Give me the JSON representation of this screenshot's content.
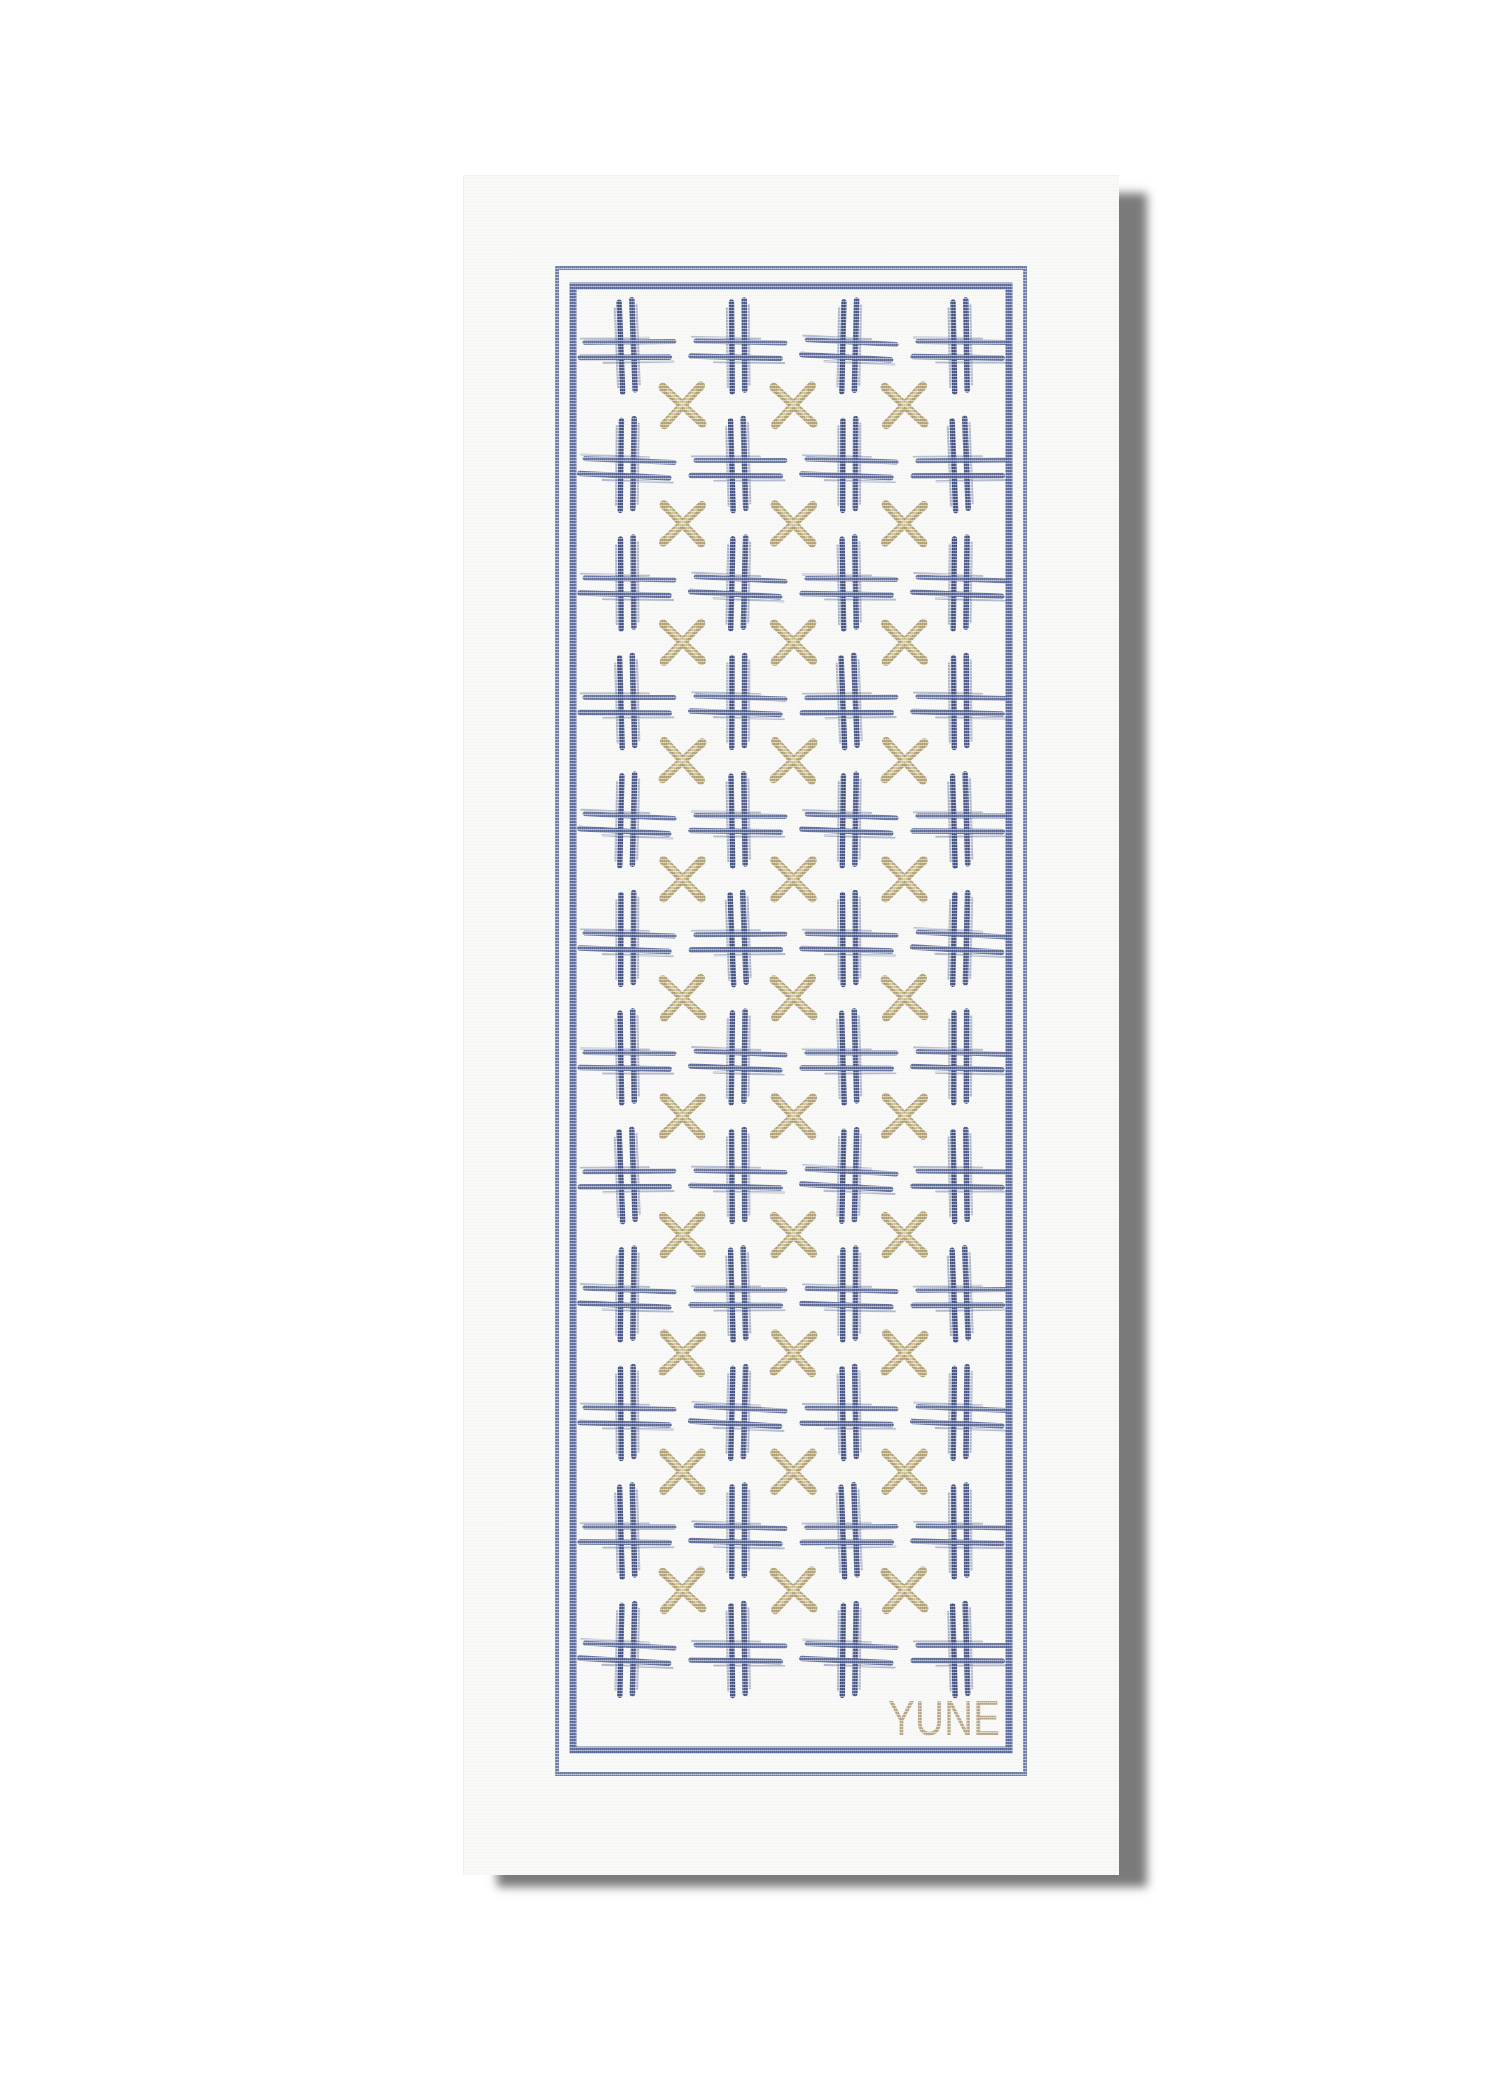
{
  "scene": {
    "object": "YUNE yoga mat product photo",
    "background_color": "#ffffff",
    "shadow_color": "rgba(0,0,0,0.52)"
  },
  "mat": {
    "surface_color": "#fbfbf9",
    "border": {
      "outer_color": "#5a6a97",
      "inner_color": "#4d5e92",
      "outer": {
        "x": 94,
        "y": 93,
        "width": 468,
        "height": 1506,
        "thickness": 4
      },
      "inner": {
        "x": 110,
        "y": 111,
        "width": 436,
        "height": 1464,
        "thickness": 7
      }
    },
    "pattern": {
      "hash": {
        "vertical_color": "#35447a",
        "horizontal_color": "#4a598a",
        "columns_x": [
          164,
          275,
          386,
          497
        ],
        "rows_y": [
          171,
          289.5,
          408,
          526.5,
          645,
          763.5,
          882,
          1000.5,
          1119,
          1237.5,
          1356,
          1474.5
        ],
        "size": 92
      },
      "cross": {
        "color": "#ab9a6b",
        "highlight_color": "#d8cda6",
        "columns_x": [
          219.5,
          330.5,
          441.5
        ],
        "rows_y": [
          230.3,
          348.8,
          467.3,
          585.8,
          704.3,
          822.8,
          941.3,
          1059.8,
          1178.3,
          1296.8,
          1415.3
        ],
        "size": 40
      }
    },
    "logo": {
      "text": "YUNE",
      "color": "#b3a284",
      "x_end": 537,
      "baseline_y": 1560,
      "font_size": 49,
      "text_length": 112
    }
  }
}
